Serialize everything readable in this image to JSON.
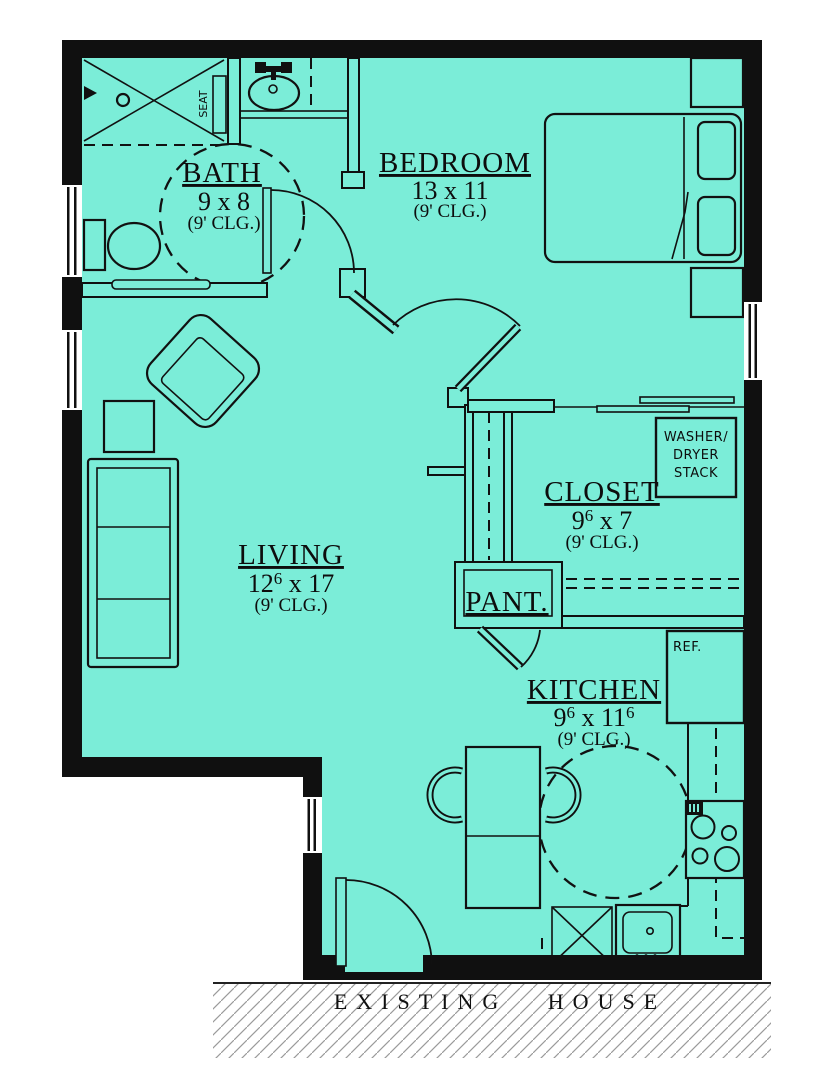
{
  "colors": {
    "floor": "#7bedd8",
    "wall": "#101010",
    "hatch_line": "#9a9a9a"
  },
  "rooms": {
    "bath": {
      "name": "BATH",
      "dims": [
        {
          "t": "9 x 8"
        }
      ],
      "ceiling": "(9' CLG.)"
    },
    "bedroom": {
      "name": "BEDROOM",
      "dims": [
        {
          "t": "13 x 11"
        }
      ],
      "ceiling": "(9' CLG.)"
    },
    "living": {
      "name": "LIVING",
      "dims": [
        {
          "t": "12"
        },
        {
          "t": "6",
          "sup": true
        },
        {
          "t": " x 17"
        }
      ],
      "ceiling": "(9' CLG.)"
    },
    "closet": {
      "name": "CLOSET",
      "dims": [
        {
          "t": "9"
        },
        {
          "t": "6",
          "sup": true
        },
        {
          "t": " x 7"
        }
      ],
      "ceiling": "(9' CLG.)"
    },
    "pantry": {
      "name": "PANT."
    },
    "kitchen": {
      "name": "KITCHEN",
      "dims": [
        {
          "t": "9"
        },
        {
          "t": "6",
          "sup": true
        },
        {
          "t": " x 11"
        },
        {
          "t": "6",
          "sup": true
        }
      ],
      "ceiling": "(9' CLG.)"
    }
  },
  "labels": {
    "washer_dryer": [
      "WASHER/",
      "DRYER",
      "STACK"
    ],
    "fridge": "REF.",
    "seat": "SEAT",
    "existing_house": "EXISTING  HOUSE"
  }
}
